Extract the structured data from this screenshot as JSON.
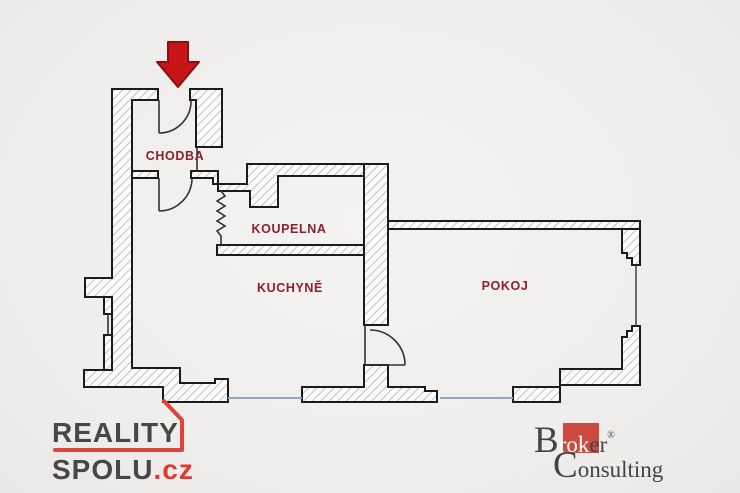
{
  "floor_plan": {
    "rooms": [
      {
        "name": "CHODBA"
      },
      {
        "name": "KOUPELNA"
      },
      {
        "name": "KUCHYNĚ"
      },
      {
        "name": "POKOJ"
      }
    ],
    "label_color": "#8e1f2d",
    "entrance_arrow_color": "#c9151a",
    "window_color": "#8fa6c7",
    "wall_outline_color": "#1b1b1b",
    "wall_hatch_color": "#a9a9a9",
    "background_color": "#eeedeb"
  },
  "branding": {
    "reality_spolu": {
      "line1": "REALITY",
      "line2": "SPOLU",
      "tld": ".cz",
      "text_color": "#474747",
      "accent_color": "#e0453b"
    },
    "broker_consulting": {
      "word1_initial": "B",
      "word1_on_square": "rok",
      "word1_rest": "er",
      "registered": "®",
      "word2_initial": "C",
      "word2_rest": "onsulting",
      "text_color": "#3f454b",
      "square_color": "#ce4a40"
    }
  }
}
